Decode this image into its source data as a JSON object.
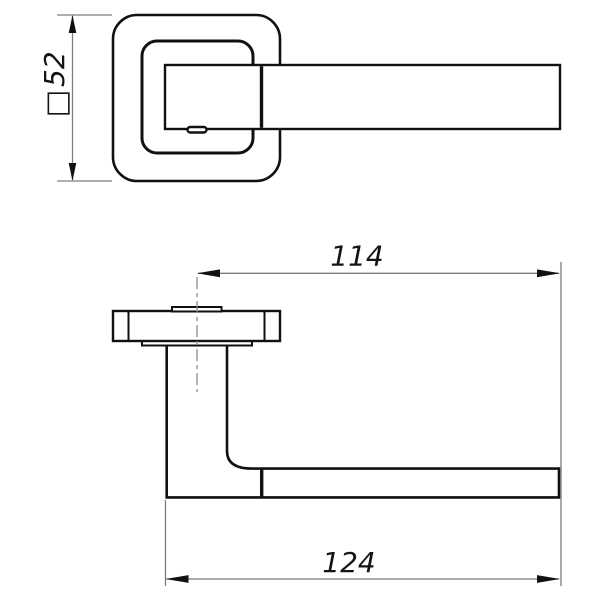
{
  "drawing": {
    "title": "door-handle-technical-drawing",
    "dimensions": {
      "rose_square": {
        "symbol": "□",
        "value": "52"
      },
      "center_to_tip": {
        "value": "114"
      },
      "overall_length": {
        "value": "124"
      }
    },
    "colors": {
      "outline": "#111111",
      "dimension_lines": "#7d7d7d",
      "background": "#ffffff"
    }
  }
}
